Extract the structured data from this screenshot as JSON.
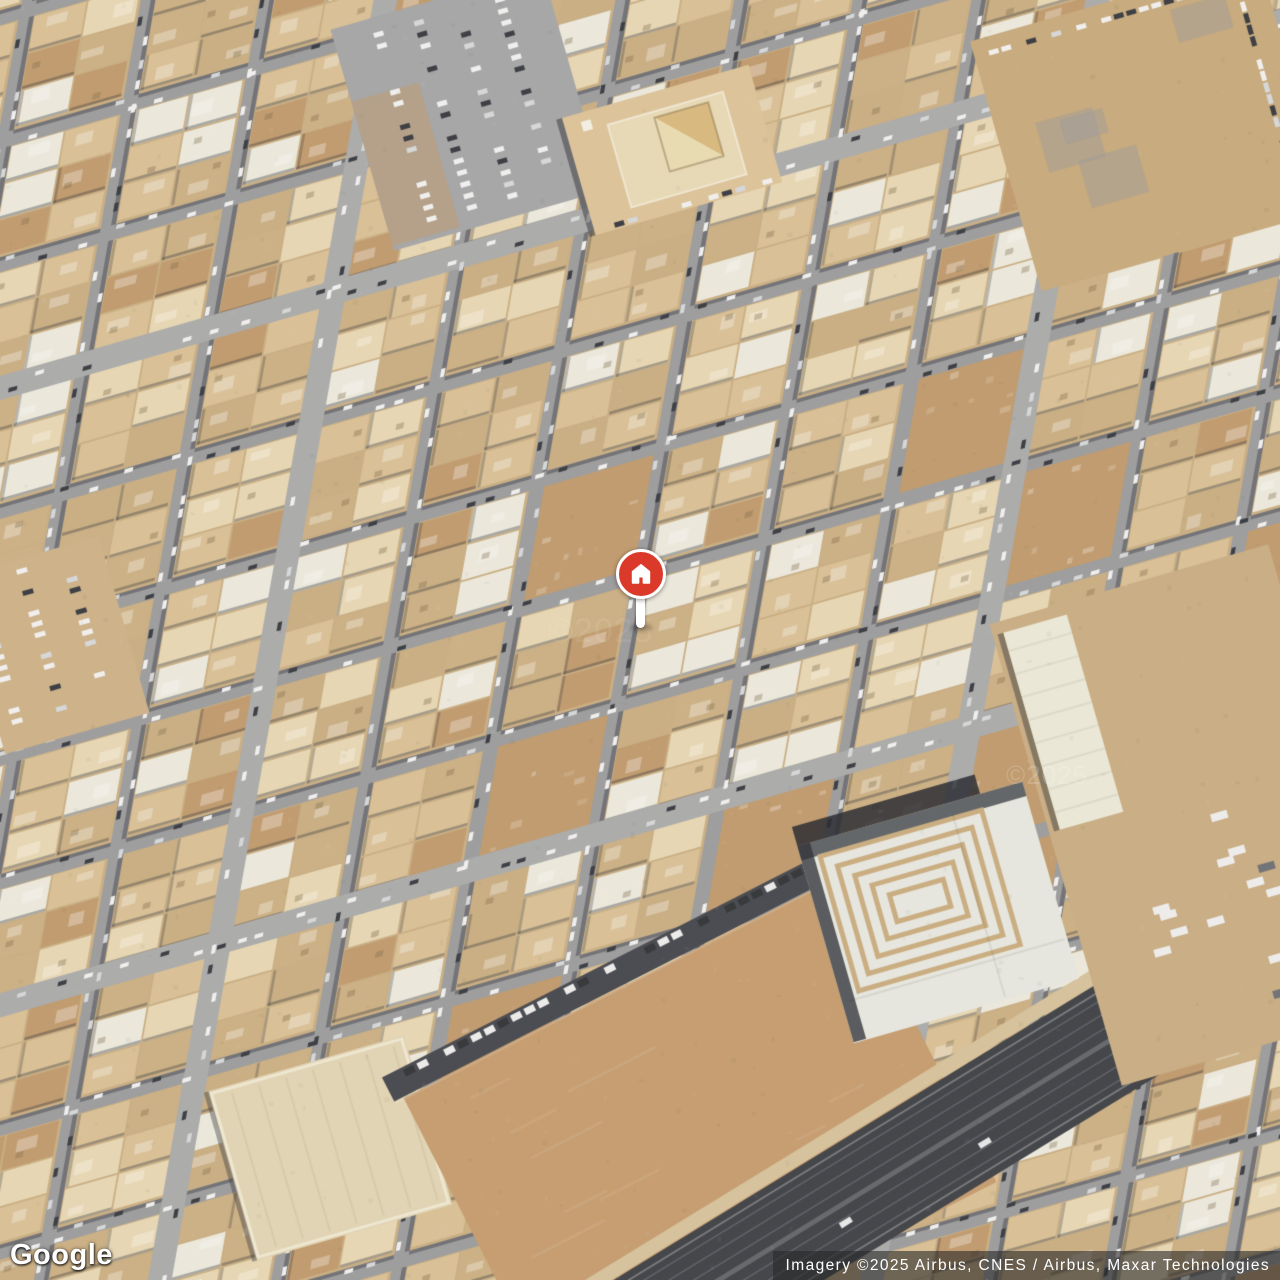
{
  "map": {
    "logo_text": "Google",
    "attribution": "Imagery ©2025 Airbus, CNES / Airbus, Maxar Technologies",
    "watermark": "©2025",
    "marker": {
      "glyph": "home-icon",
      "color": "#db3a2b",
      "ring_color": "#ffffff",
      "glyph_color": "#ffffff"
    },
    "colors": {
      "sand": "#c9ae83",
      "parcel_mid": "#d9c096",
      "parcel_light": "#e7d7b4",
      "roof_white": "#eceadf",
      "parcel_tan": "#ccb084",
      "dirt": "#c09a6d",
      "road": "#9b9c9e",
      "road_light": "#a9aaac",
      "asphalt_dark": "#3c3f46",
      "shadow": "#2b2e36",
      "lot_tan": "#c59c6f",
      "plaza_white": "#e7e8e2",
      "plaza_step": "#c9ad80",
      "car_white": "#f2f2f2",
      "car_silver": "#d6d8db",
      "car_dark": "#35383f"
    }
  }
}
